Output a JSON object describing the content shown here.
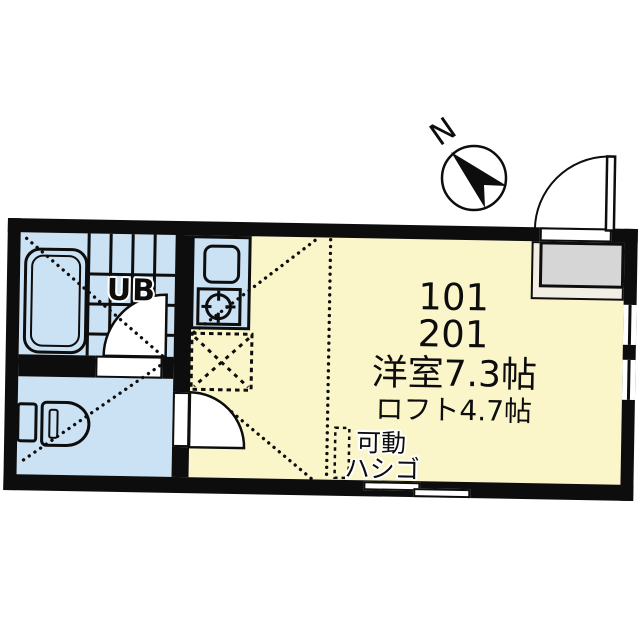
{
  "plan": {
    "title_note": "apartment floor plan",
    "labels": {
      "unit_number_1": "101",
      "unit_number_2": "201",
      "main_room_size": "洋室7.3帖",
      "loft_size": "ロフト4.7帖",
      "ladder_line1": "可動",
      "ladder_line2": "ハシゴ",
      "unit_bath": "UB",
      "compass_north": "N"
    },
    "colors": {
      "wall": "#0d0d0d",
      "main_room_yellow": "#fbf6c9",
      "wet_area_blue": "#cbe2f4",
      "genkan_gray": "#d6d6d6",
      "genkan_step_cream": "#f3eee4",
      "background": "#ffffff"
    },
    "rooms": [
      {
        "name": "unit-bath",
        "label": "UB"
      },
      {
        "name": "toilet-room",
        "label": ""
      },
      {
        "name": "kitchen",
        "label": ""
      },
      {
        "name": "main-room",
        "label": "101 / 201 洋室7.3帖 ロフト4.7帖"
      }
    ]
  }
}
